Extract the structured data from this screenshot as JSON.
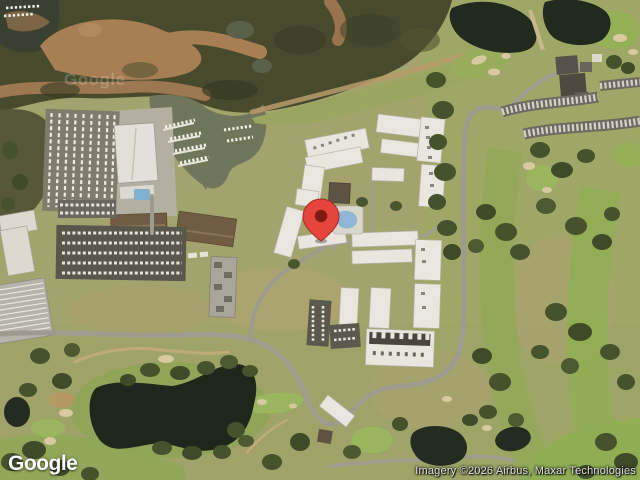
{
  "map": {
    "view_type": "satellite",
    "provider_logo": "Google",
    "center_watermark": "Google",
    "attribution": "Imagery ©2026 Airbus, Maxar Technologies",
    "marker": {
      "name": "location-pin",
      "pixel_x": 321,
      "pixel_y": 241,
      "body_color": "#E5453C",
      "dot_color": "#7E1B12"
    },
    "palette": {
      "marsh_trees": "#474a2c",
      "tidal_channel": "#a87f53",
      "lagoon_water": "#70765c",
      "pond_water": "#1f271d",
      "grass_rough": "#a3a36d",
      "fairway_green": "#93a958",
      "putting_green": "#9ab65e",
      "sand_bunker": "#d8c9a0",
      "building_roof": "#e8e6df",
      "brown_roof": "#6f5c43",
      "road": "#9e9a8e",
      "parking": "#59564c",
      "pool_water": "#8fb6d4"
    },
    "features": [
      "mangrove-marsh",
      "tidal-channels",
      "marina-boatyard",
      "boat-docks",
      "condo-complex",
      "swimming-pool",
      "golf-course",
      "sand-bunkers",
      "clubhouse",
      "parking-lots",
      "lakes",
      "roads"
    ]
  }
}
